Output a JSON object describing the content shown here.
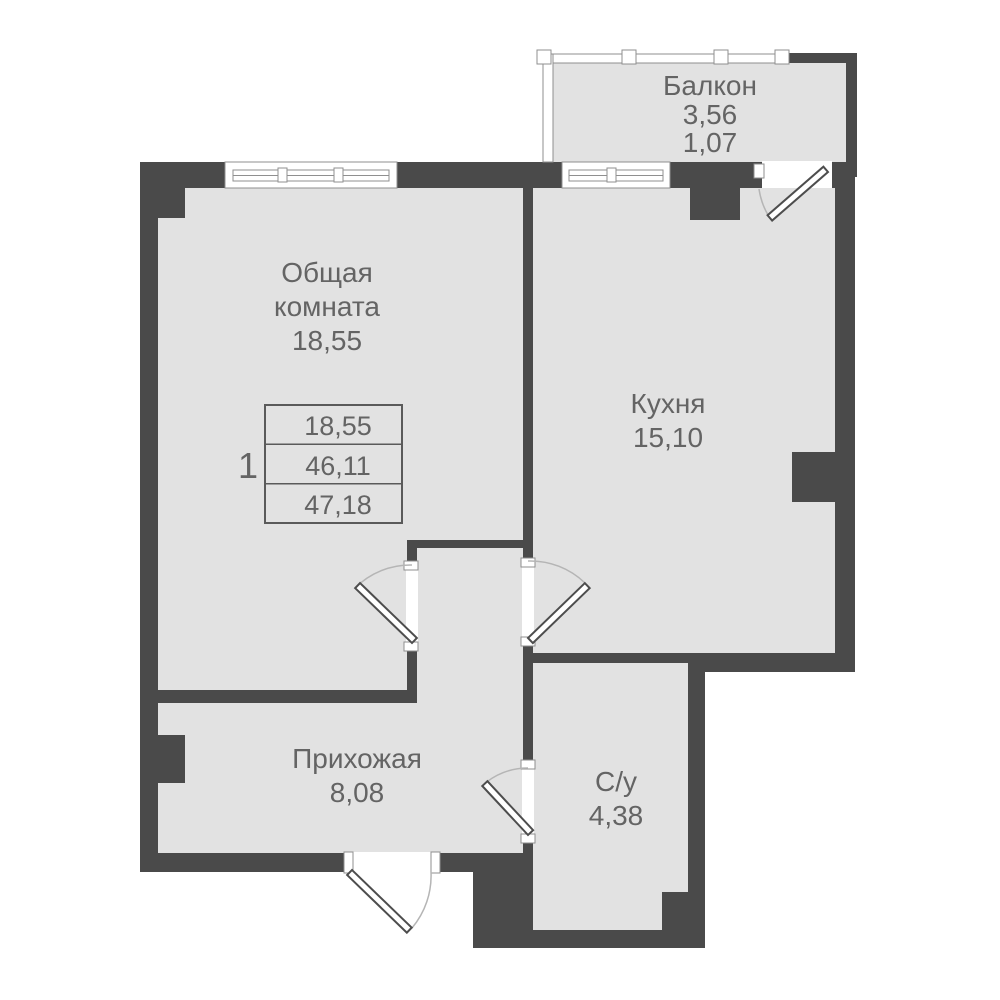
{
  "plan": {
    "type": "apartment-floor-plan",
    "colors": {
      "wall": "#4a4a4a",
      "room_fill": "#e2e2e2",
      "background": "#ffffff",
      "text": "#646464",
      "door_arc": "#b5b5b5",
      "frame_outline": "#8f8f8f"
    }
  },
  "rooms": {
    "balcony": {
      "name": "Балкон",
      "area": "3,56",
      "area_reduced": "1,07"
    },
    "living": {
      "lines": [
        "Общая",
        "комната"
      ],
      "area": "18,55"
    },
    "kitchen": {
      "name": "Кухня",
      "area": "15,10"
    },
    "hallway": {
      "name": "Прихожая",
      "area": "8,08"
    },
    "bathroom": {
      "name": "С/у",
      "area": "4,38"
    }
  },
  "summary_table": {
    "apartment_number": "1",
    "rows": [
      "18,55",
      "46,11",
      "47,18"
    ]
  }
}
